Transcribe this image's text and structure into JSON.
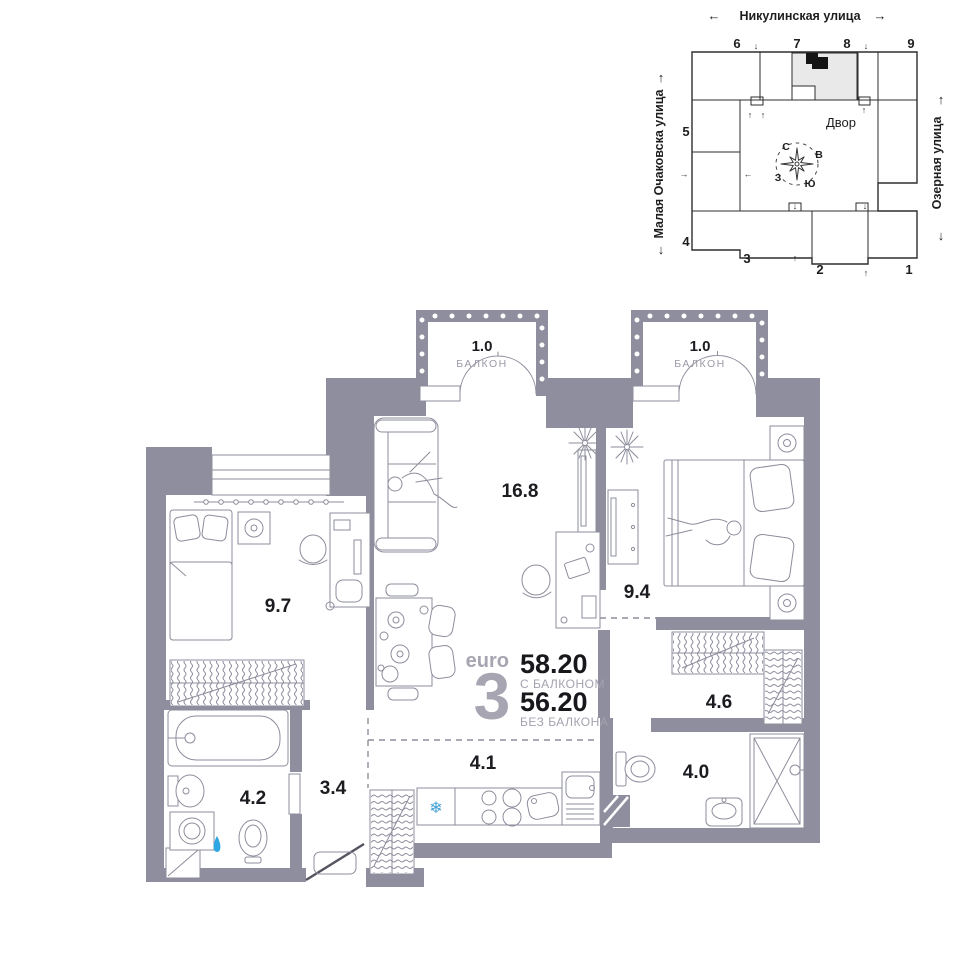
{
  "site_plan": {
    "street_top": "Никулинская улица",
    "street_left": "Малая Очаковска улица",
    "street_right": "Озерная улица",
    "courtyard_label": "Двор",
    "compass": {
      "north": "С",
      "east": "В",
      "south": "Ю",
      "west": "З"
    },
    "building_numbers": [
      "1",
      "2",
      "3",
      "4",
      "5",
      "6",
      "7",
      "8",
      "9"
    ],
    "arrows": {
      "up": "↑",
      "down": "↓",
      "left": "←",
      "right": "→"
    }
  },
  "floor_plan": {
    "balconies": [
      {
        "area": "1.0",
        "label": "БАЛКОН"
      },
      {
        "area": "1.0",
        "label": "БАЛКОН"
      }
    ],
    "rooms": {
      "bedroom_small": "9.7",
      "living_room": "16.8",
      "bedroom_master": "9.4",
      "wardrobe": "4.6",
      "bathroom_shower": "4.0",
      "kitchen": "4.1",
      "hallway": "3.4",
      "bathroom_tub": "4.2"
    },
    "info": {
      "type_prefix": "euro",
      "rooms_count": "3",
      "area_with_balcony": "58.20",
      "with_balcony_label": "С БАЛКОНОМ",
      "area_without_balcony": "56.20",
      "without_balcony_label": "БЕЗ БАЛКОНА"
    },
    "icons": {
      "snowflake": "❄"
    }
  },
  "colors": {
    "wall": "#8F8E9E",
    "furniture_line": "#8e8d9c",
    "highlight_section": "#e9e9e9",
    "selected_unit": "#141414",
    "water_blue": "#2ba7e3",
    "snowflake_blue": "#3f9fd8"
  }
}
